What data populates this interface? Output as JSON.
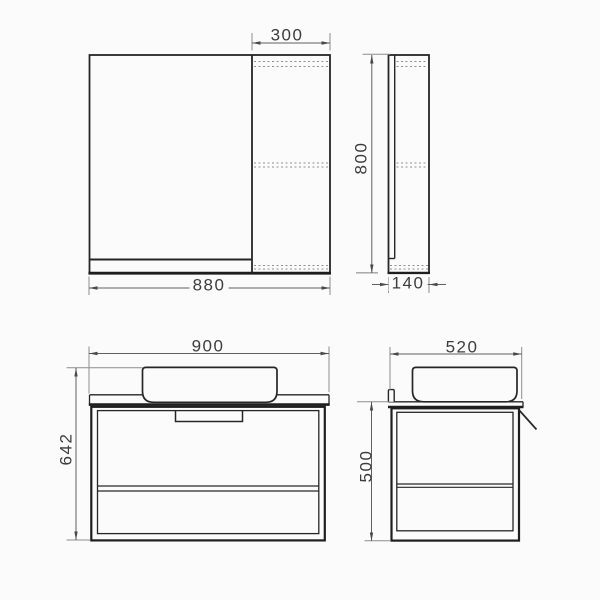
{
  "drawing": {
    "kind": "technical-drawing",
    "subject": "wall-hung bathroom vanity with countertop basin and mirror cabinet",
    "units": "mm",
    "colors": {
      "background": "#fbfbfb",
      "object_line": "#262626",
      "dimension_line": "#5f5f5f",
      "extension_line": "#8d8d8d",
      "hidden_dashed_line": "#8f8f8f",
      "text": "#3c3c3c"
    },
    "views": {
      "mirror_front": {
        "label": "mirror-cabinet-front-view",
        "dims": {
          "side_cabinet_width": "300",
          "total_width": "880"
        }
      },
      "mirror_side": {
        "label": "mirror-cabinet-side-view",
        "dims": {
          "height": "800",
          "depth": "140"
        }
      },
      "vanity_front": {
        "label": "vanity-front-view",
        "dims": {
          "width": "900",
          "height": "642"
        }
      },
      "vanity_side": {
        "label": "vanity-side-view",
        "dims": {
          "depth": "520",
          "height": "500"
        }
      }
    }
  }
}
